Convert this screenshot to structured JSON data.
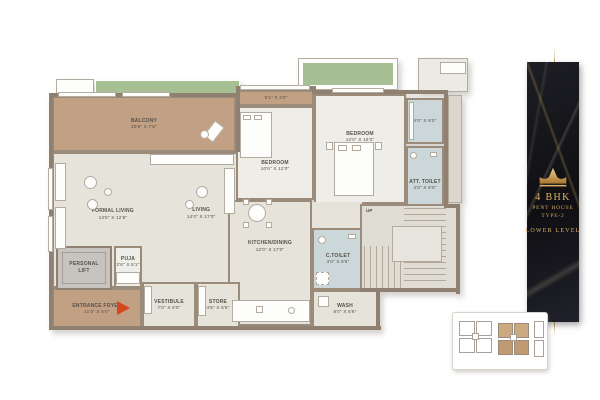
{
  "plan": {
    "rooms": {
      "balcony": {
        "name": "BALCONY",
        "dims": "20'6\" X 7'5\""
      },
      "balcony_strip": {
        "name": "",
        "dims": "9'1\" X 2'0\""
      },
      "formal_living": {
        "name": "FORMAL LIVING",
        "dims": "13'6\" X 12'8\""
      },
      "living": {
        "name": "LIVING",
        "dims": "14'0\" X 17'0\""
      },
      "bedroom1": {
        "name": "BEDROOM",
        "dims": "10'6\" X 12'0\""
      },
      "bedroom2": {
        "name": "BEDROOM",
        "dims": "12'0\" X 16'0\""
      },
      "dress": {
        "name": "",
        "dims": "4'0\" X 8'0\""
      },
      "att_toilet": {
        "name": "ATT. TOILET",
        "dims": "4'0\" X 8'0\""
      },
      "kitchen_dining": {
        "name": "KITCHEN/DINING",
        "dims": "12'0\" X 17'0\""
      },
      "c_toilet": {
        "name": "C.TOILET",
        "dims": "4'0\" X 6'6\""
      },
      "wash": {
        "name": "WASH",
        "dims": "8'0\" X 6'6\""
      },
      "store": {
        "name": "STORE",
        "dims": "4'6\" X 6'6\""
      },
      "vestibule": {
        "name": "VESTIBULE",
        "dims": "7'0\" X 6'0\""
      },
      "entrance_foyer": {
        "name": "ENTRANCE FOYER",
        "dims": "11'0\" X 6'0\""
      },
      "personal_lift": {
        "name": "PERSONAL LIFT",
        "dims": ""
      },
      "puja": {
        "name": "PUJA",
        "dims": "2'6\" X 5'1\""
      },
      "staircase": {
        "name": "UP",
        "dims": ""
      }
    },
    "entry_arrow_color": "#d6481e"
  },
  "panel": {
    "logo": "crown-icon",
    "bhk": "4 BHK",
    "line1": "PENT HOUSE",
    "line2": "TYPE-2",
    "level": "LOWER LEVEL",
    "gold": "#dcb469",
    "background": "#15161b"
  },
  "colors": {
    "floor": "#e6e3db",
    "balcony_tan": "#c1a083",
    "toilet_blue": "#ccd7d9",
    "wall": "#8f8071",
    "planter_green": "#a6bf93",
    "keyplan_highlight": "#cba981"
  }
}
